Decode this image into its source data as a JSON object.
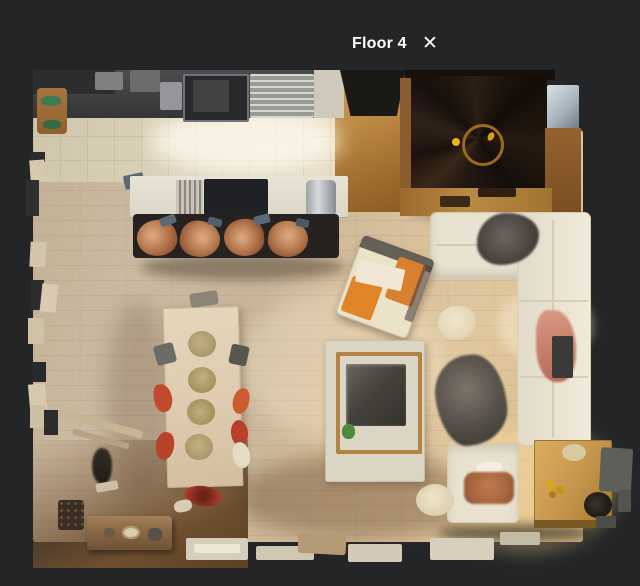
{
  "header": {
    "floor_label": "Floor 4",
    "close_icon": "✕"
  },
  "scene": {
    "type": "3d-dollhouse-floorplan-top-view",
    "floor": "Floor 4",
    "visible_objects": [
      "kitchen counter with sink and dish rack",
      "cutting board",
      "kitchen island with cooktop and grill",
      "four copper bar stools",
      "spiral staircase",
      "white sectional sofa",
      "gray fur throw",
      "salmon blanket",
      "dark sheepskin rug",
      "round cream pouf",
      "orange armchair",
      "fire-pit coffee table",
      "wooden dining table with four plates",
      "red and gray dining chairs",
      "wooden sideboard bench",
      "small statue",
      "wooden side table with decor",
      "window frame fragments",
      "radiators along bottom wall"
    ]
  },
  "colors": {
    "bg": "#232527",
    "ink": "#ffffff",
    "floor-a": "#c7b49a",
    "floor-b": "#e0c79d",
    "tile": "#dcd2ba",
    "counter": "#3d3f41",
    "island": "#e8e3d5",
    "stool": "#b5764e",
    "stair": "#1a120c",
    "stair-wood": "#8a5c30",
    "sofa": "#e9e2d1",
    "rug": "#544e48",
    "chair-orange": "#d8802f",
    "table-wood": "#decbb0",
    "plate": "#ab9b6c",
    "chair-red": "#c04a2b",
    "ct-cream": "#dbd5c4",
    "ct-frame": "#b28344",
    "ct-center": "#45423c",
    "side-table": "#c6974e",
    "blanket": "#c8806a",
    "pillow": "#a8653f"
  }
}
